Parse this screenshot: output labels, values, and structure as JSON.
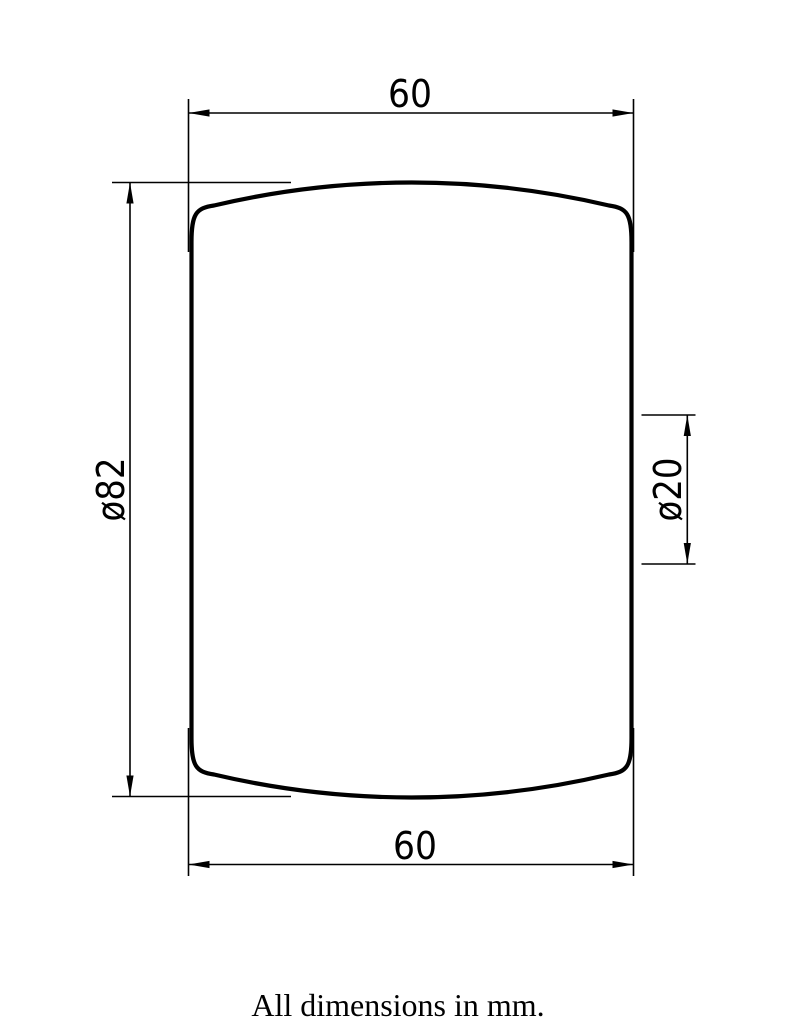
{
  "drawing": {
    "title": "technical drawing of barrel-shaped part",
    "caption": "All dimensions in mm.",
    "dimensions": {
      "top_width": "60",
      "bottom_width": "60",
      "height_diameter": "ø82",
      "band_diameter": "ø20"
    },
    "colors": {
      "line": "#000000",
      "background": "#ffffff"
    }
  }
}
